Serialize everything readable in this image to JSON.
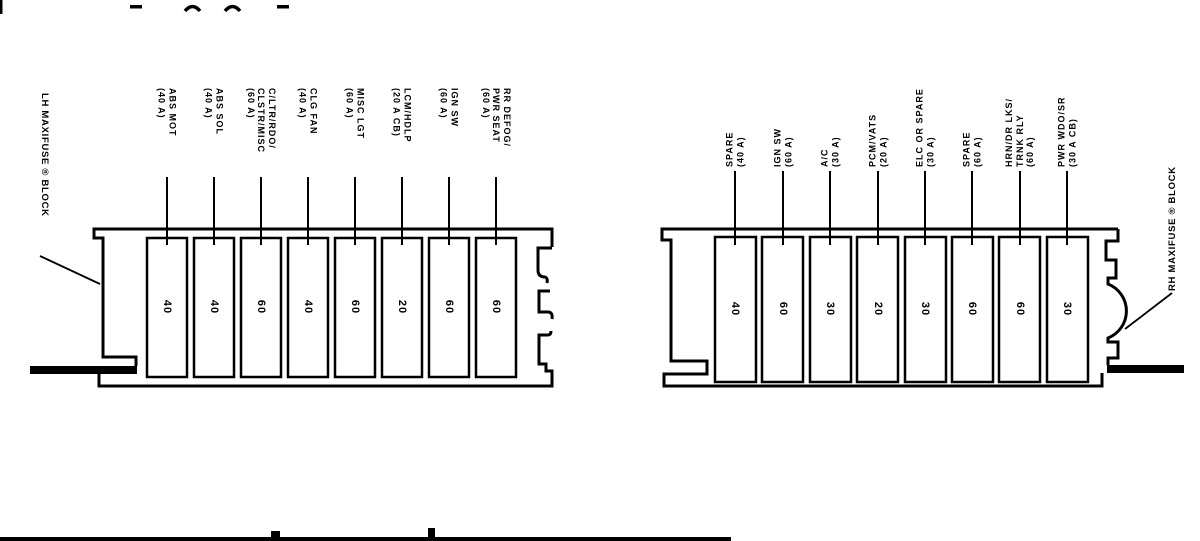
{
  "diagram": {
    "ink_color": "#000000",
    "background_color": "#ffffff"
  },
  "left_block": {
    "label": "LH MAXIFUSE ® BLOCK",
    "fuses": [
      {
        "amps": "40",
        "lines": [
          "ABS MOT",
          "(40 A)"
        ]
      },
      {
        "amps": "40",
        "lines": [
          "ABS SOL",
          "(40 A)"
        ]
      },
      {
        "amps": "60",
        "lines": [
          "C/LTR/RDO/",
          "CLSTR/MISC",
          "(60 A)"
        ]
      },
      {
        "amps": "40",
        "lines": [
          "CLG FAN",
          "(40 A)"
        ]
      },
      {
        "amps": "60",
        "lines": [
          "MISC LGT",
          "(60 A)"
        ]
      },
      {
        "amps": "20",
        "lines": [
          "LCM/HDLP",
          "(20 A CB)"
        ]
      },
      {
        "amps": "60",
        "lines": [
          "IGN SW",
          "(60 A)"
        ]
      },
      {
        "amps": "60",
        "lines": [
          "RR DEFOG/",
          "PWR SEAT",
          "(60 A)"
        ]
      }
    ]
  },
  "right_block": {
    "label": "RH MAXIFUSE ® BLOCK",
    "fuses": [
      {
        "amps": "40",
        "lines": [
          "SPARE",
          "(40 A)"
        ]
      },
      {
        "amps": "60",
        "lines": [
          "IGN SW",
          "(60 A)"
        ]
      },
      {
        "amps": "30",
        "lines": [
          "A/C",
          "(30 A)"
        ]
      },
      {
        "amps": "20",
        "lines": [
          "PCM/VATS",
          "(20 A)"
        ]
      },
      {
        "amps": "30",
        "lines": [
          "ELC OR SPARE",
          "(30 A)"
        ]
      },
      {
        "amps": "60",
        "lines": [
          "SPARE",
          "(60 A)"
        ]
      },
      {
        "amps": "60",
        "lines": [
          "HRN/DR LKS/",
          "TRNK RLY",
          "(60 A)"
        ]
      },
      {
        "amps": "30",
        "lines": [
          "PWR WDO/SR",
          "(30 A CB)"
        ]
      }
    ]
  }
}
